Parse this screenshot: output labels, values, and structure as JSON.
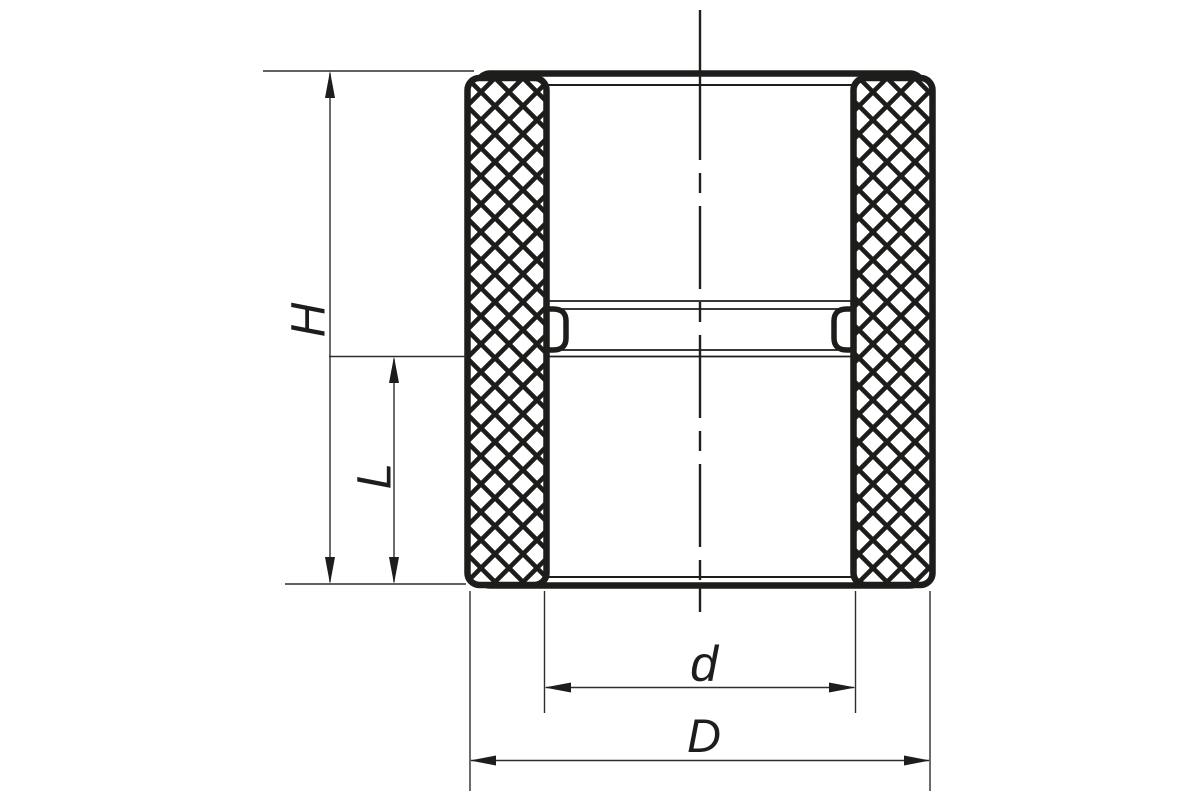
{
  "colors": {
    "ink": "#1d1d1b",
    "dim_line": "#2e2e2e",
    "background": "#ffffff"
  },
  "drawing": {
    "subject": "pipe-coupling-front-view",
    "knurl_texture": "diamond-crosshatch",
    "axis_style": "dash-dot-centerline"
  },
  "dimensions": {
    "H": {
      "label": "H"
    },
    "L": {
      "label": "L"
    },
    "d": {
      "label": "d"
    },
    "D": {
      "label": "D"
    }
  }
}
